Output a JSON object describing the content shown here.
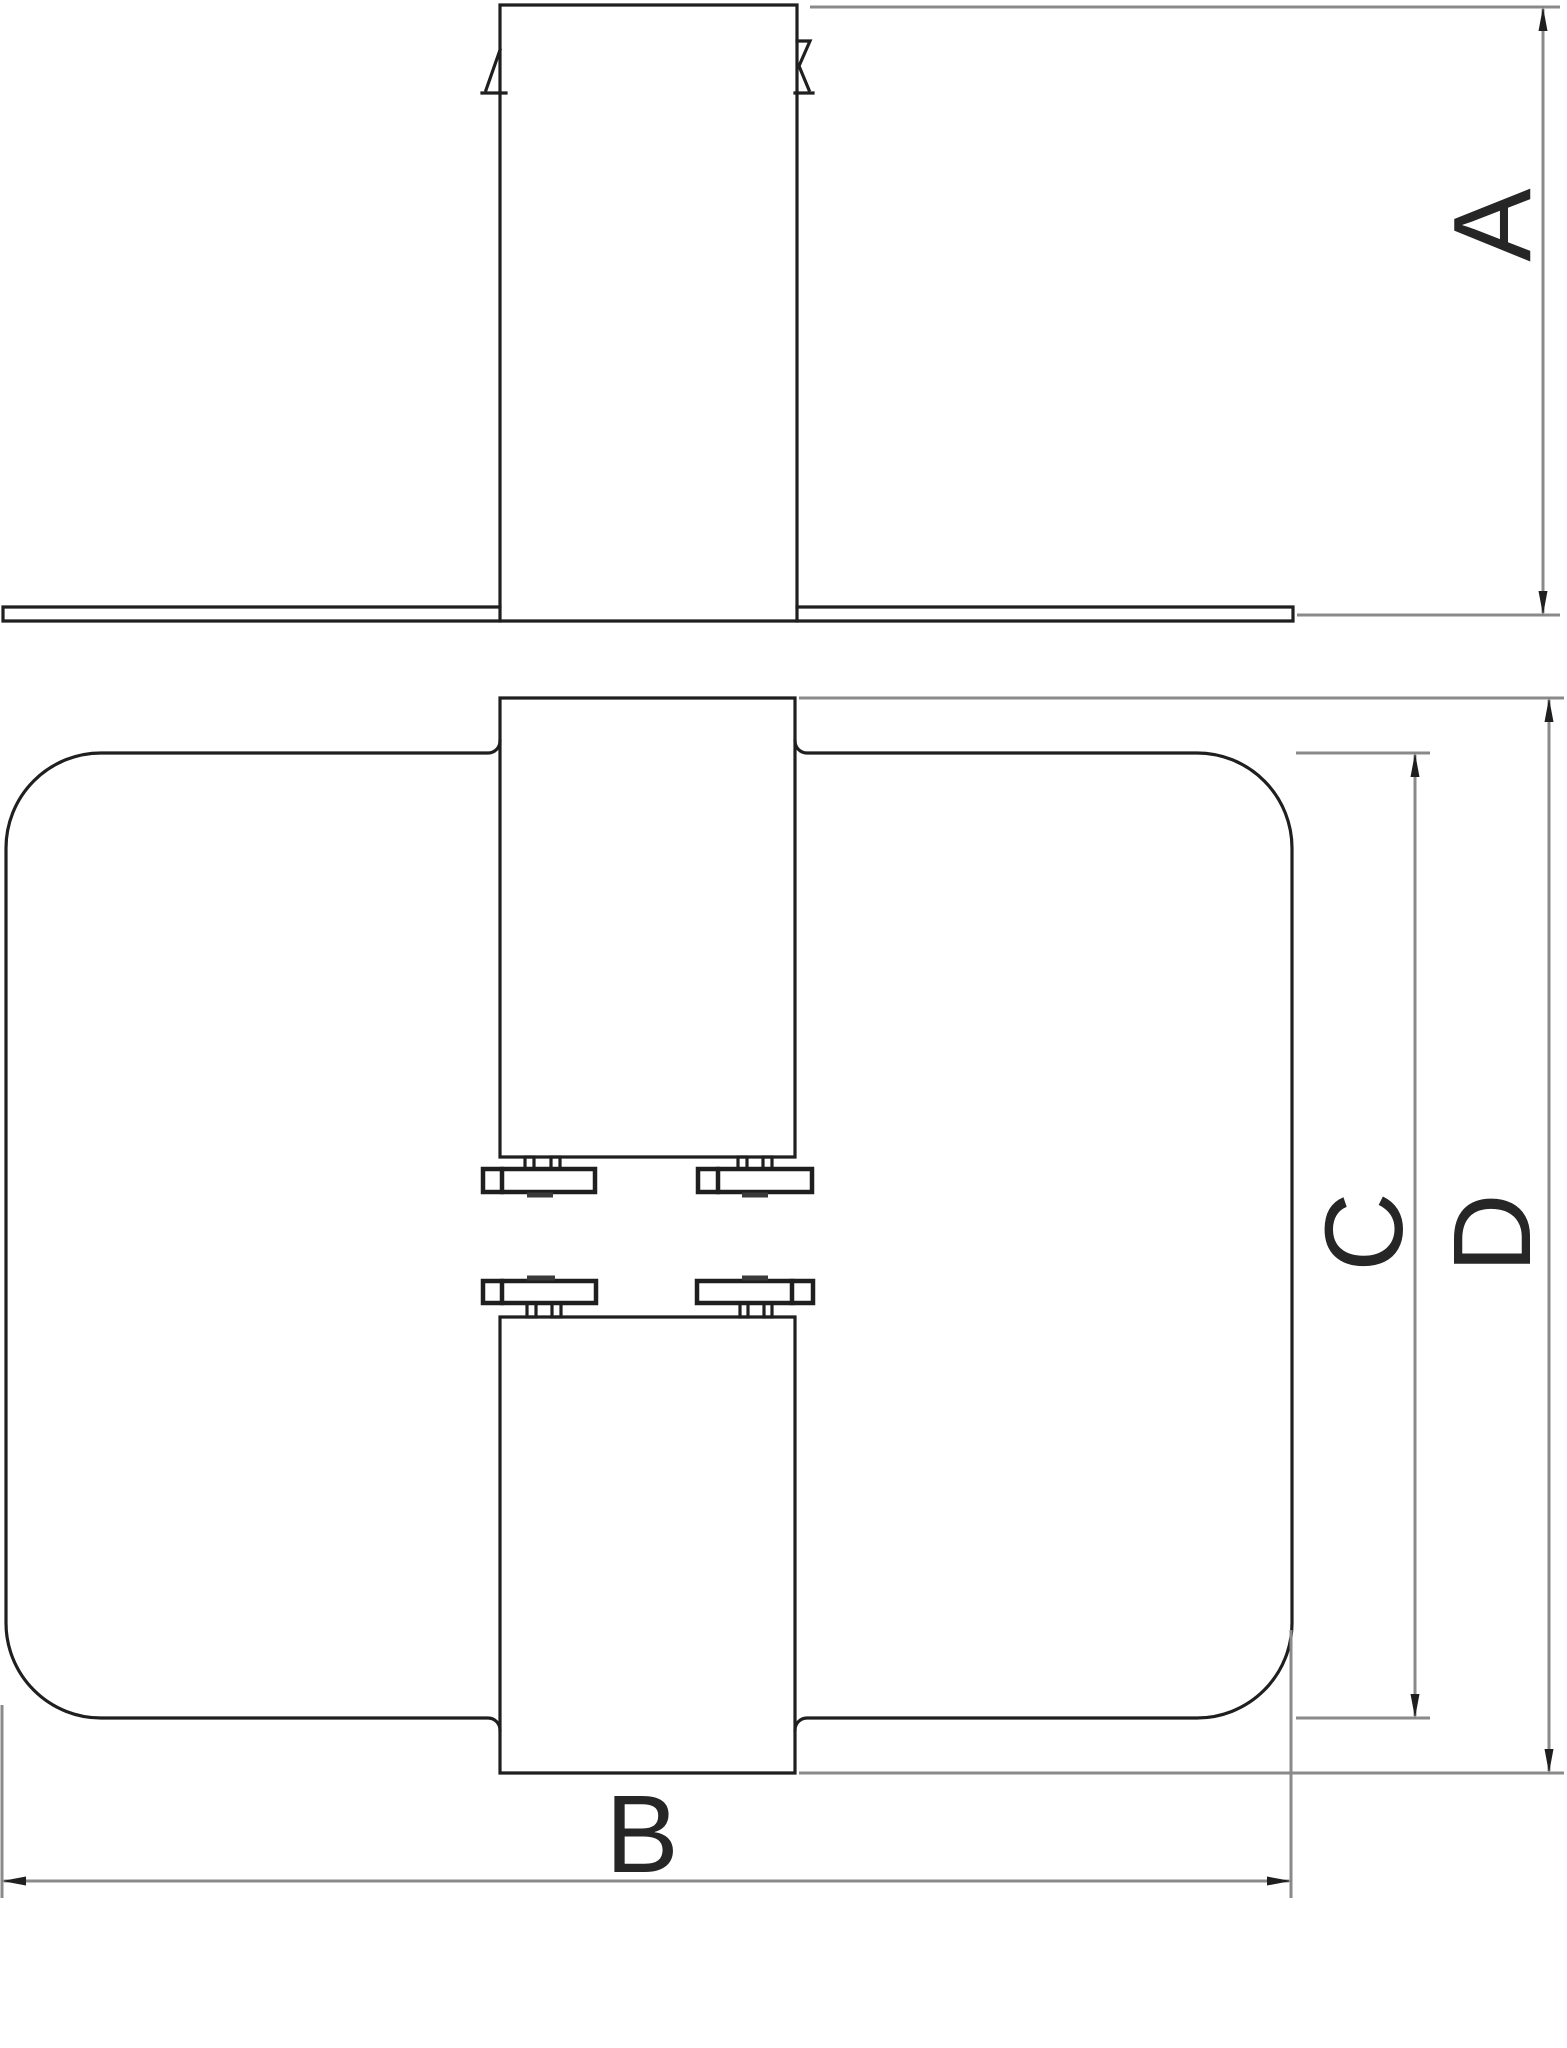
{
  "drawing": {
    "dimension_labels": {
      "a": "A",
      "b": "B",
      "c": "C",
      "d": "D"
    },
    "colors": {
      "outline": "#1f1f1f",
      "dimension_line": "#8a8a8a",
      "label_text": "#262626",
      "background": "#ffffff"
    }
  }
}
